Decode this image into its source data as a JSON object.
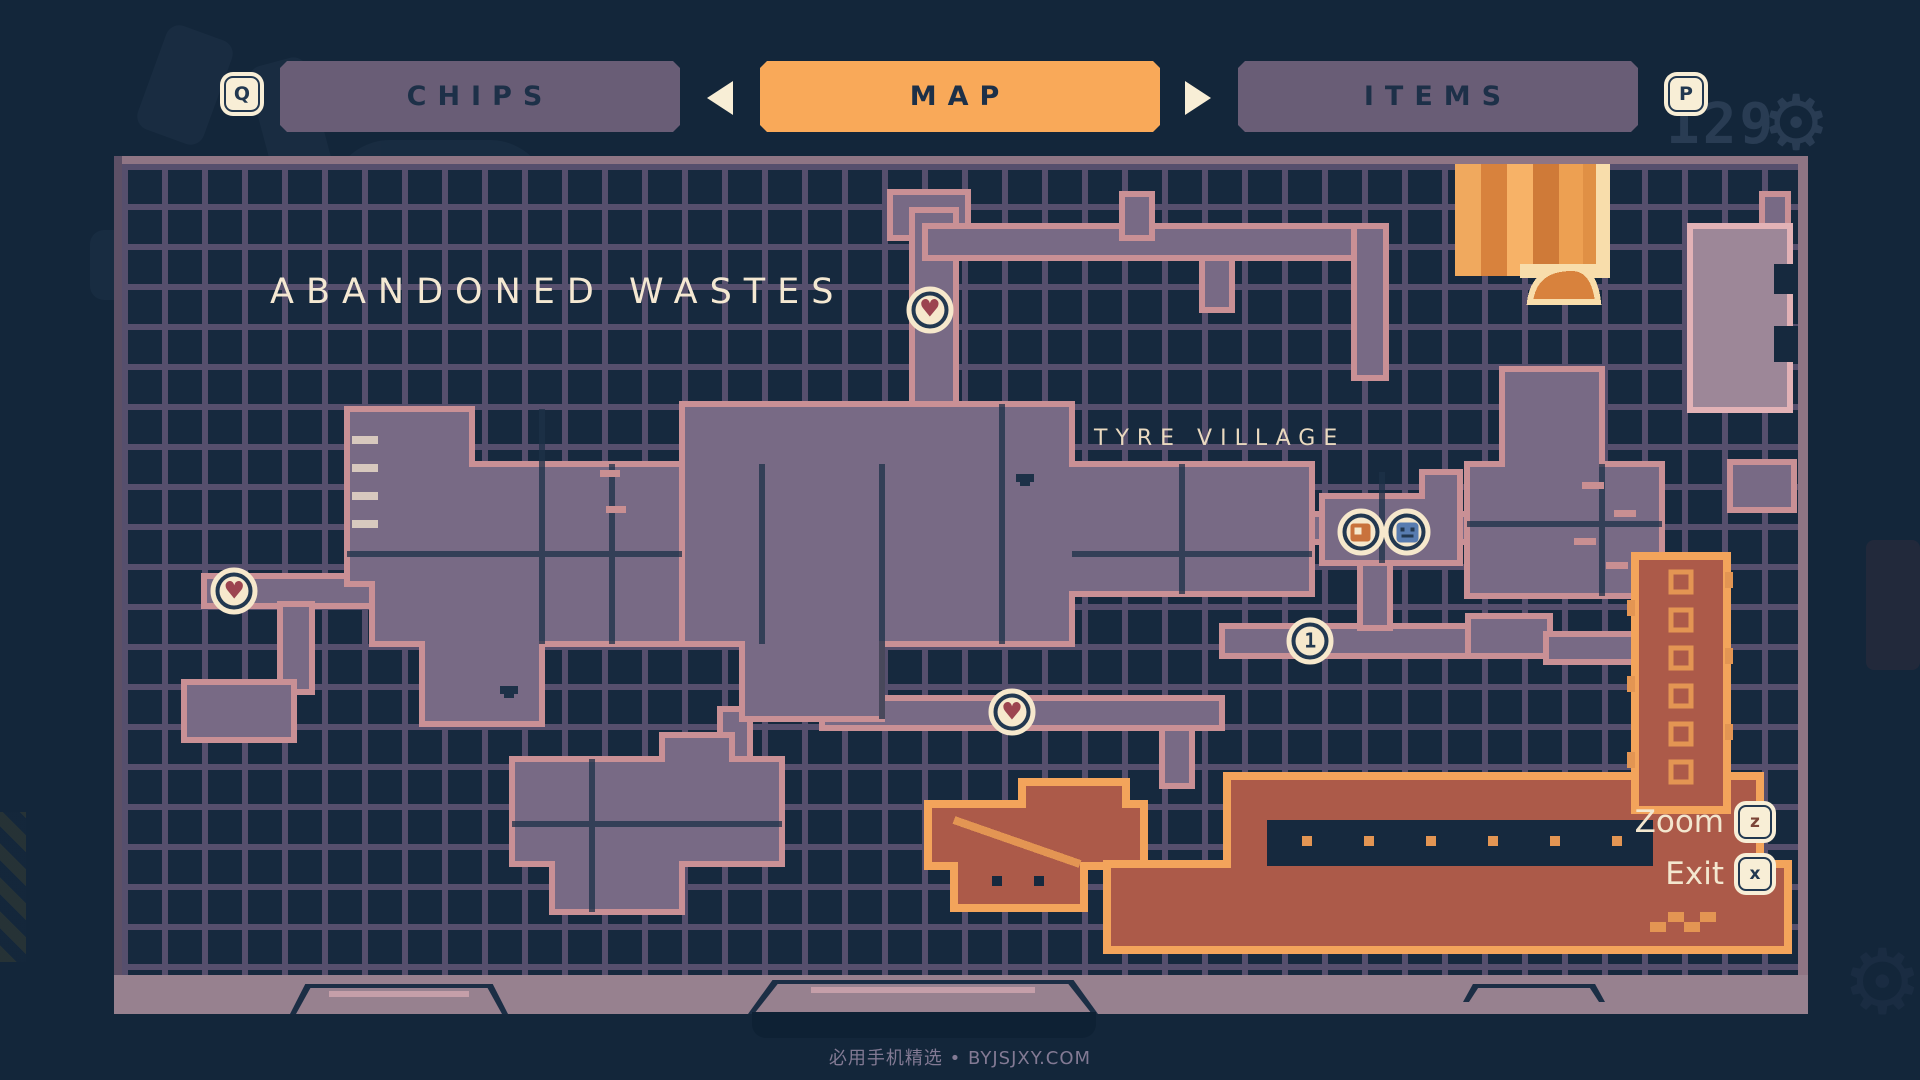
{
  "header": {
    "key_left": "Q",
    "key_right": "P",
    "tabs": [
      {
        "id": "chips",
        "label": "CHIPS",
        "active": false
      },
      {
        "id": "map",
        "label": "MAP",
        "active": true
      },
      {
        "id": "items",
        "label": "ITEMS",
        "active": false
      }
    ]
  },
  "hud": {
    "scrap_count": "129",
    "gear_icon": "⚙"
  },
  "map": {
    "region_title": "ABANDONED WASTES",
    "area_label": "TYRE VILLAGE",
    "markers": [
      {
        "id": "health-station-top",
        "type": "heart",
        "glyph": "♥",
        "x": 48.2,
        "y": 18.0
      },
      {
        "id": "health-station-left",
        "type": "heart",
        "glyph": "♥",
        "x": 6.7,
        "y": 52.7
      },
      {
        "id": "health-station-mid",
        "type": "heart",
        "glyph": "♥",
        "x": 53.1,
        "y": 67.6
      },
      {
        "id": "shop-station",
        "type": "shop",
        "glyph": "",
        "x": 73.9,
        "y": 45.4
      },
      {
        "id": "save-station",
        "type": "save",
        "glyph": "",
        "x": 76.7,
        "y": 45.4
      },
      {
        "id": "numbered-station",
        "type": "one",
        "glyph": "1",
        "x": 70.9,
        "y": 58.8
      }
    ],
    "controls": [
      {
        "id": "zoom",
        "label": "Zoom",
        "key": "z"
      },
      {
        "id": "exit",
        "label": "Exit",
        "key": "x"
      }
    ]
  },
  "footer": {
    "watermark": "必用手机精选 • BYJSJXY.COM"
  },
  "colors": {
    "accent_orange": "#f9a959",
    "cream": "#f6e8cc",
    "navy": "#1d3048",
    "map_bg": "#16293e",
    "grid": "#564f6d",
    "room_mauve": "#786a85",
    "room_outline": "#c99095",
    "room_red": "#ac5a49",
    "room_orange_border": "#f3a45b",
    "panel_frame": "#97818f"
  }
}
